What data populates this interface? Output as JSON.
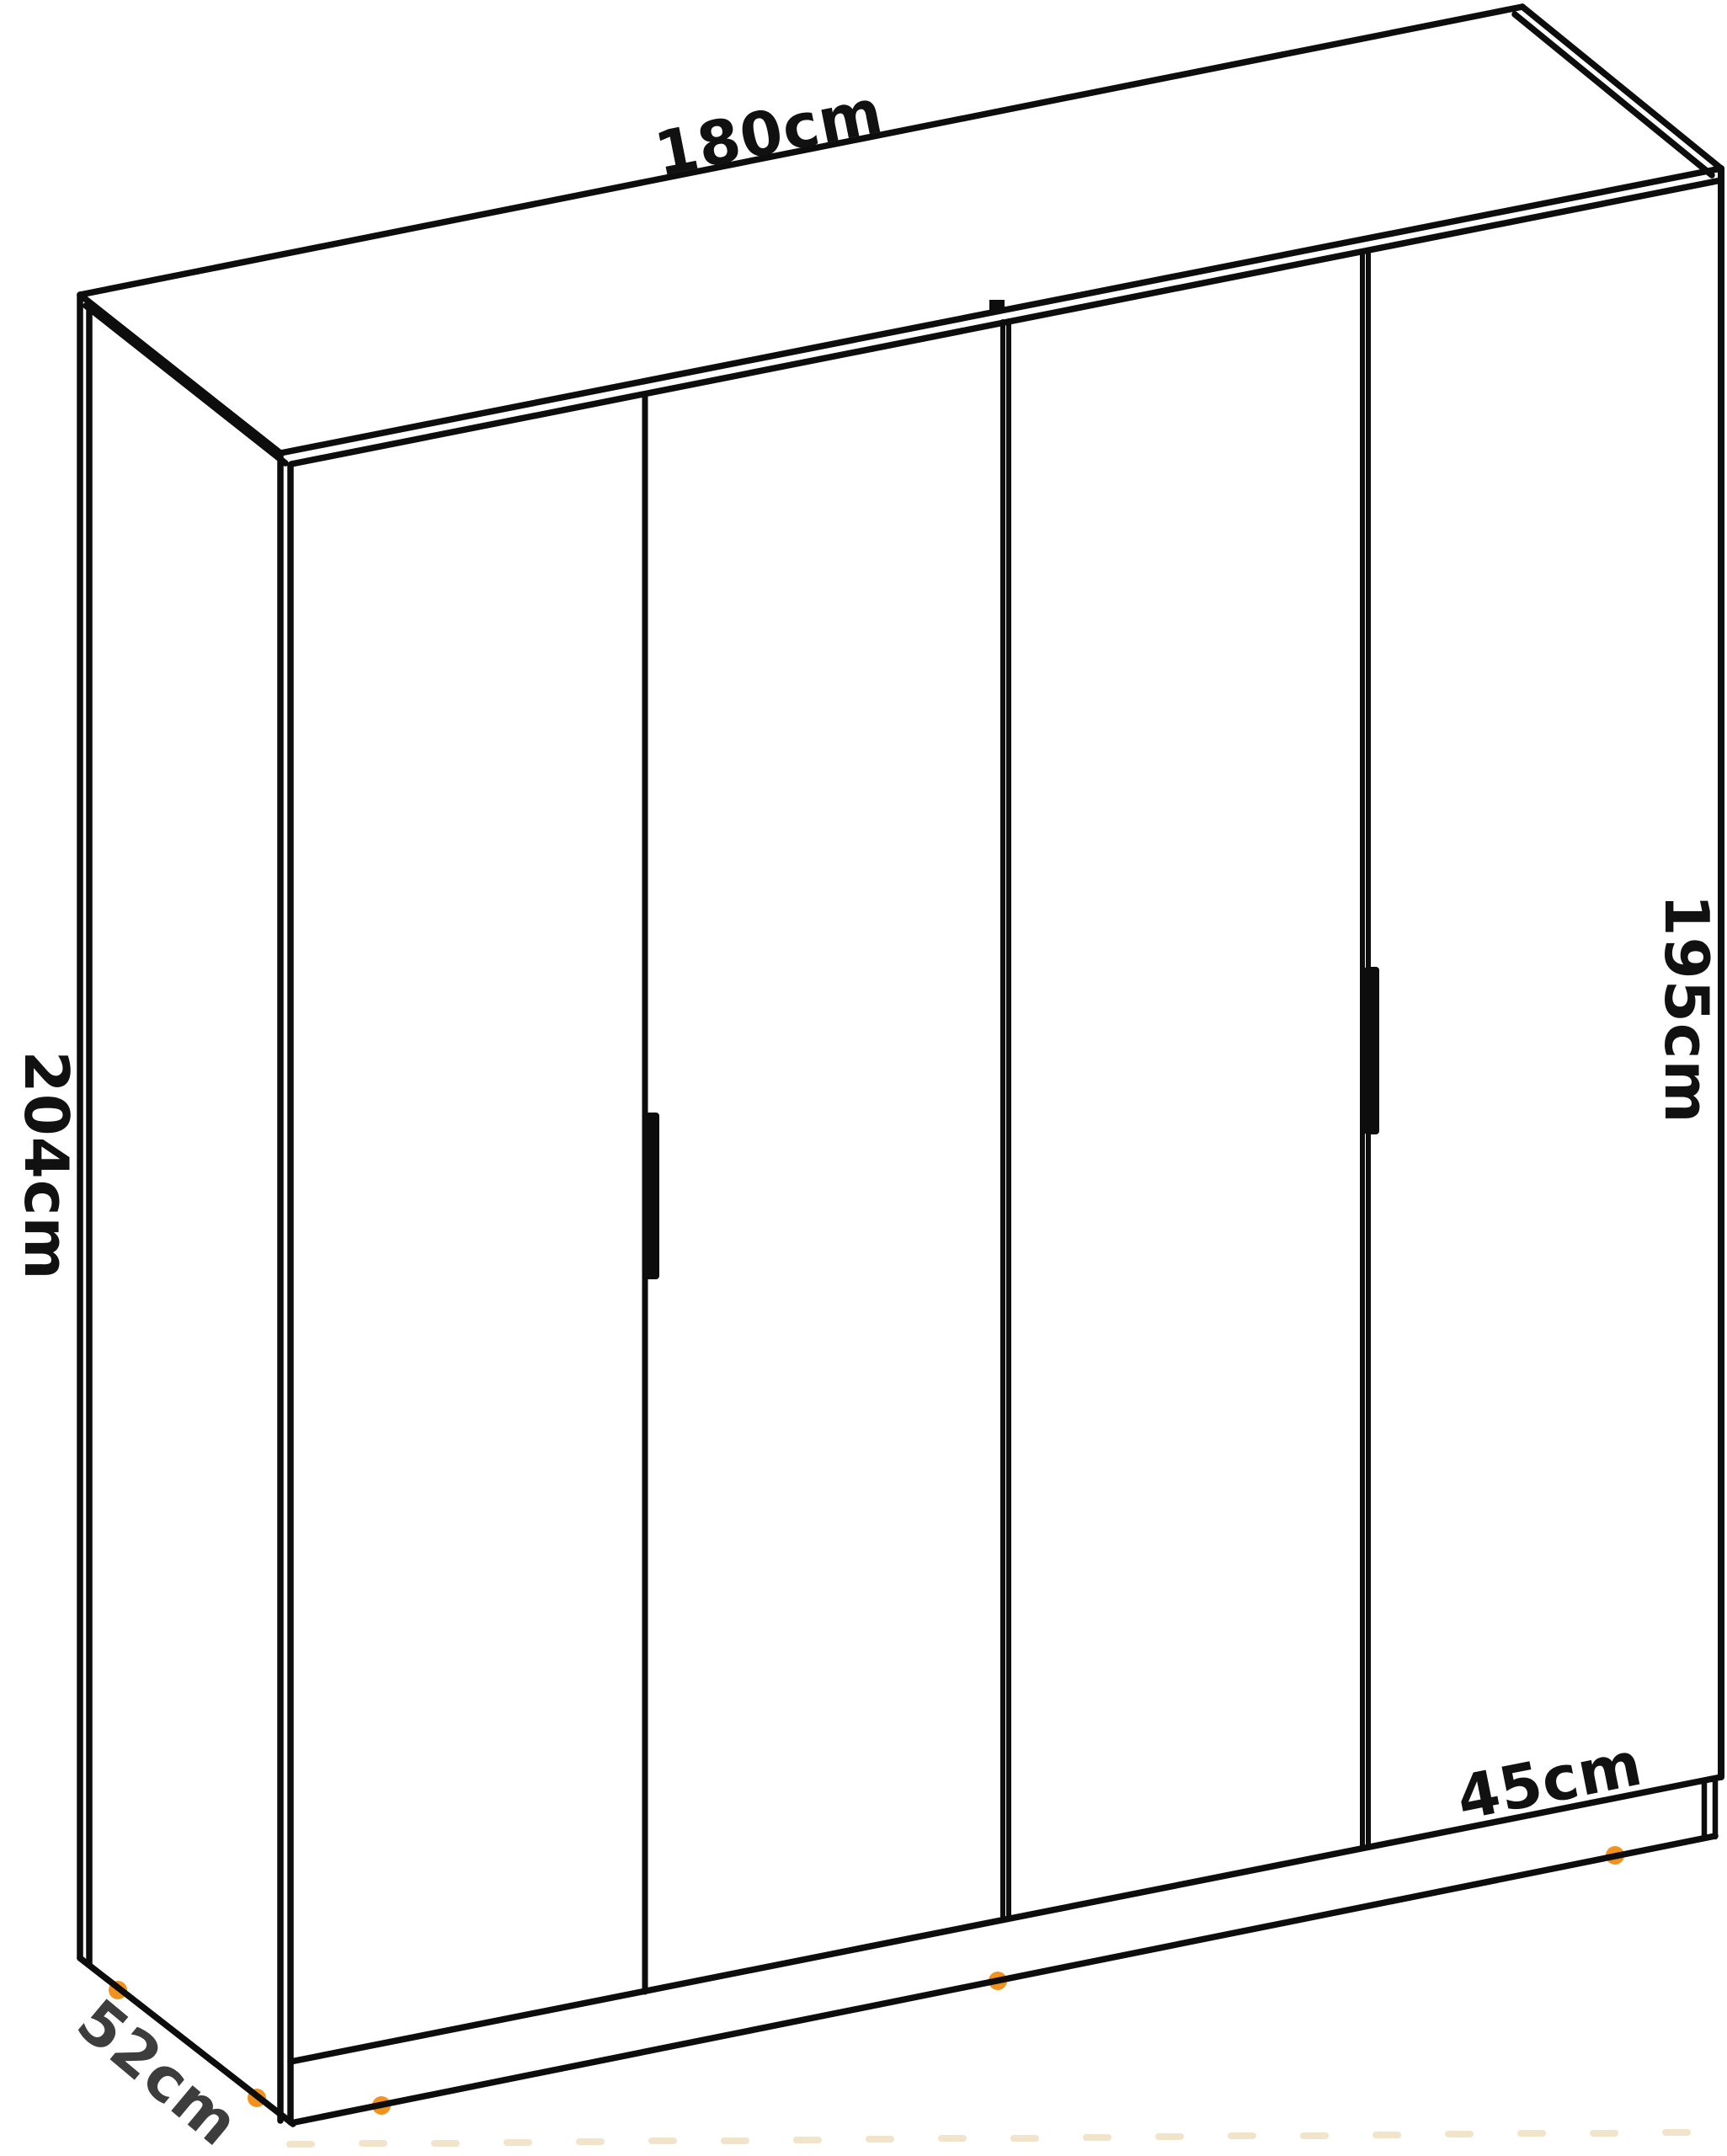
{
  "diagram": {
    "type": "furniture-dimension-diagram",
    "subject": "four-door wardrobe",
    "dimensions": {
      "width": "180cm",
      "height_total": "204cm",
      "height_right": "195cm",
      "door_width": "45cm",
      "depth": "52cm"
    },
    "counts": {
      "doors": 4,
      "handles": 2,
      "feet_visible": 5
    },
    "colors": {
      "background": "#ffffff",
      "line": "#0d0d0d",
      "label": "#111111",
      "depth_label": "#3d3d3d",
      "feet_accent": "#F2921E",
      "floor_marks": "#F2E3CB"
    }
  }
}
